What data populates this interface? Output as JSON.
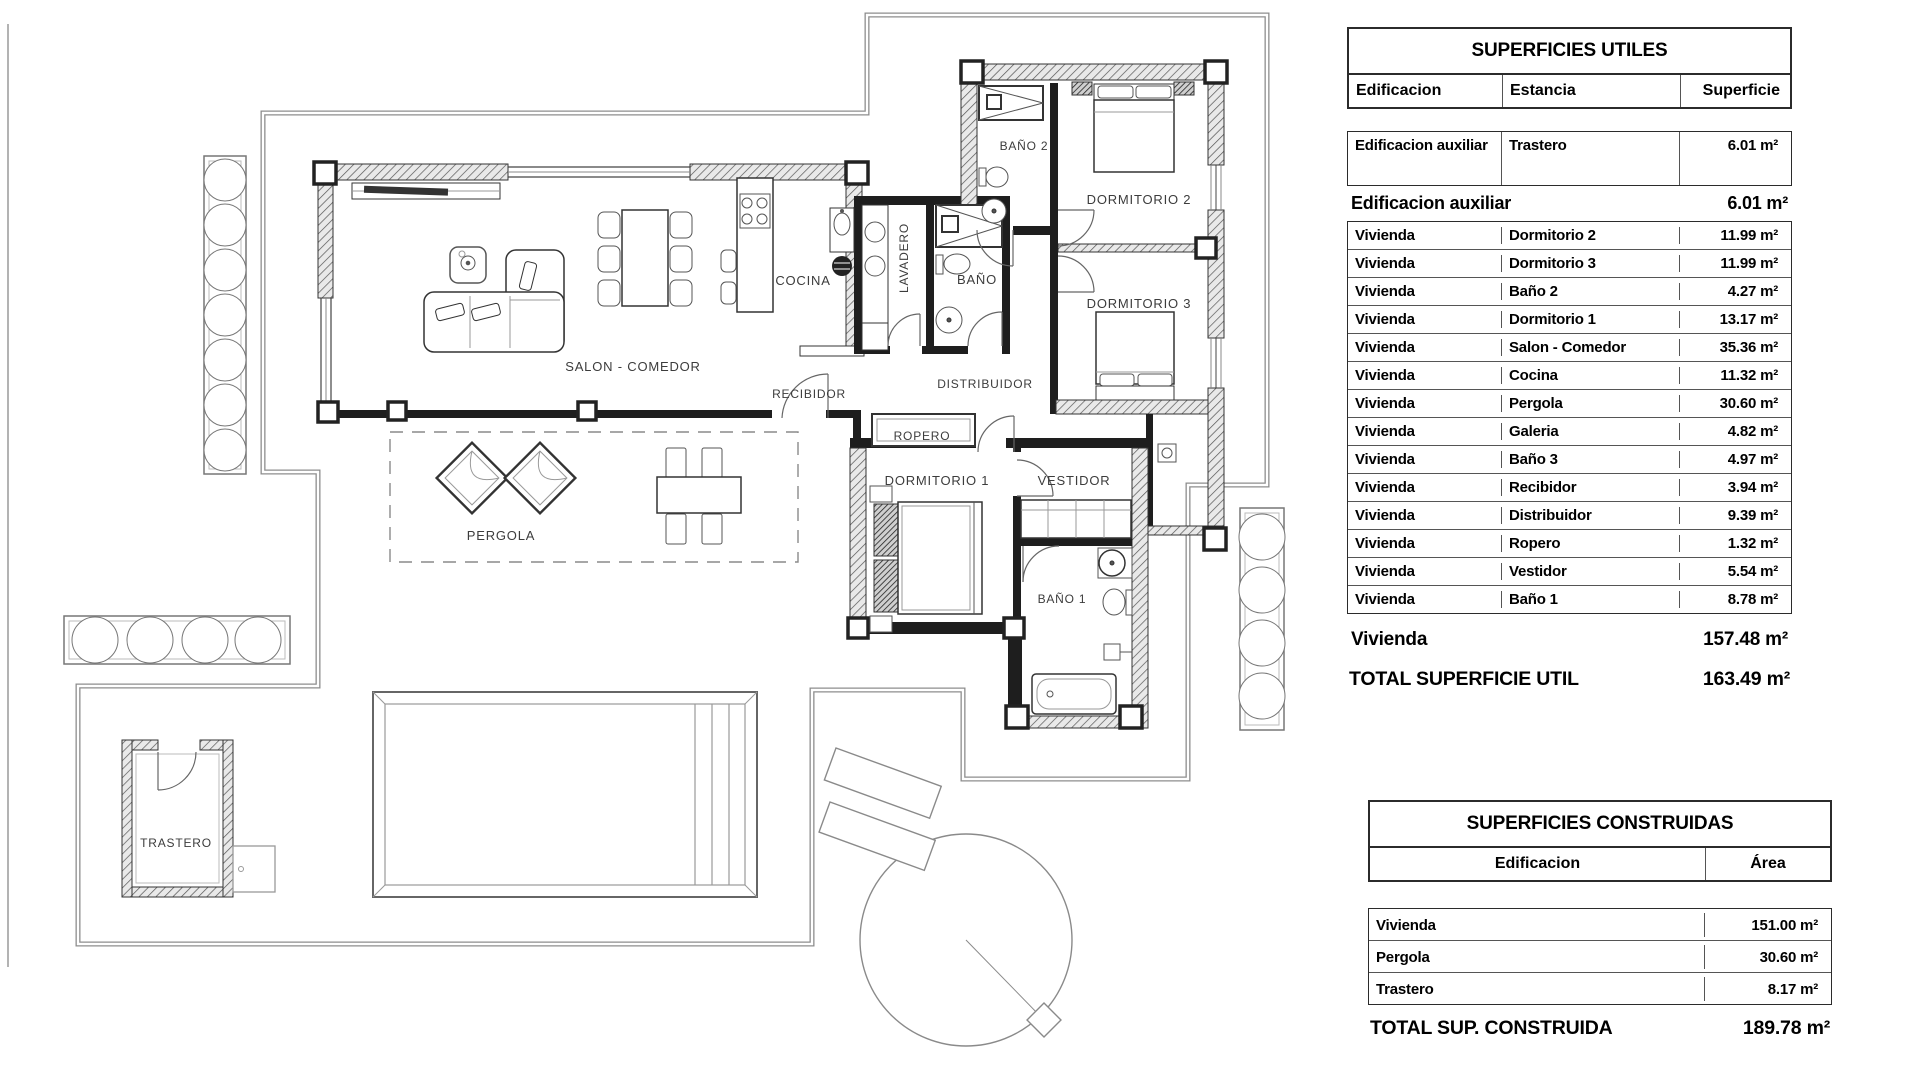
{
  "plan": {
    "rooms": {
      "salon": "SALON - COMEDOR",
      "cocina": "COCINA",
      "lavadero": "LAVADERO",
      "bano": "BAÑO",
      "bano2": "BAÑO 2",
      "dormitorio2": "DORMITORIO 2",
      "dormitorio3": "DORMITORIO 3",
      "recibidor": "RECIBIDOR",
      "distribuidor": "DISTRIBUIDOR",
      "ropero": "ROPERO",
      "dormitorio1": "DORMITORIO 1",
      "vestidor": "VESTIDOR",
      "bano1": "BAÑO 1",
      "pergola": "PERGOLA",
      "trastero": "TRASTERO"
    }
  },
  "tables": {
    "utiles": {
      "title": "SUPERFICIES UTILES",
      "headers": {
        "edificacion": "Edificacion",
        "estancia": "Estancia",
        "superficie": "Superficie"
      },
      "aux_row": {
        "edificacion": "Edificacion auxiliar",
        "estancia": "Trastero",
        "superficie": "6.01 m²"
      },
      "aux_subtotal": {
        "label": "Edificacion auxiliar",
        "value": "6.01 m²"
      },
      "rows": [
        {
          "edificacion": "Vivienda",
          "estancia": "Dormitorio 2",
          "superficie": "11.99 m²"
        },
        {
          "edificacion": "Vivienda",
          "estancia": "Dormitorio 3",
          "superficie": "11.99 m²"
        },
        {
          "edificacion": "Vivienda",
          "estancia": "Baño 2",
          "superficie": "4.27 m²"
        },
        {
          "edificacion": "Vivienda",
          "estancia": "Dormitorio 1",
          "superficie": "13.17 m²"
        },
        {
          "edificacion": "Vivienda",
          "estancia": "Salon - Comedor",
          "superficie": "35.36 m²"
        },
        {
          "edificacion": "Vivienda",
          "estancia": "Cocina",
          "superficie": "11.32 m²"
        },
        {
          "edificacion": "Vivienda",
          "estancia": "Pergola",
          "superficie": "30.60 m²"
        },
        {
          "edificacion": "Vivienda",
          "estancia": "Galeria",
          "superficie": "4.82 m²"
        },
        {
          "edificacion": "Vivienda",
          "estancia": "Baño 3",
          "superficie": "4.97 m²"
        },
        {
          "edificacion": "Vivienda",
          "estancia": "Recibidor",
          "superficie": "3.94 m²"
        },
        {
          "edificacion": "Vivienda",
          "estancia": "Distribuidor",
          "superficie": "9.39 m²"
        },
        {
          "edificacion": "Vivienda",
          "estancia": "Ropero",
          "superficie": "1.32 m²"
        },
        {
          "edificacion": "Vivienda",
          "estancia": "Vestidor",
          "superficie": "5.54 m²"
        },
        {
          "edificacion": "Vivienda",
          "estancia": "Baño 1",
          "superficie": "8.78 m²"
        }
      ],
      "vivienda_subtotal": {
        "label": "Vivienda",
        "value": "157.48 m²"
      },
      "total": {
        "label": "TOTAL SUPERFICIE UTIL",
        "value": "163.49 m²"
      }
    },
    "construidas": {
      "title": "SUPERFICIES CONSTRUIDAS",
      "headers": {
        "edificacion": "Edificacion",
        "area": "Área"
      },
      "rows": [
        {
          "edificacion": "Vivienda",
          "area": "151.00 m²"
        },
        {
          "edificacion": "Pergola",
          "area": "30.60 m²"
        },
        {
          "edificacion": "Trastero",
          "area": "8.17 m²"
        }
      ],
      "total": {
        "label": "TOTAL SUP. CONSTRUIDA",
        "value": "189.78 m²"
      }
    }
  }
}
